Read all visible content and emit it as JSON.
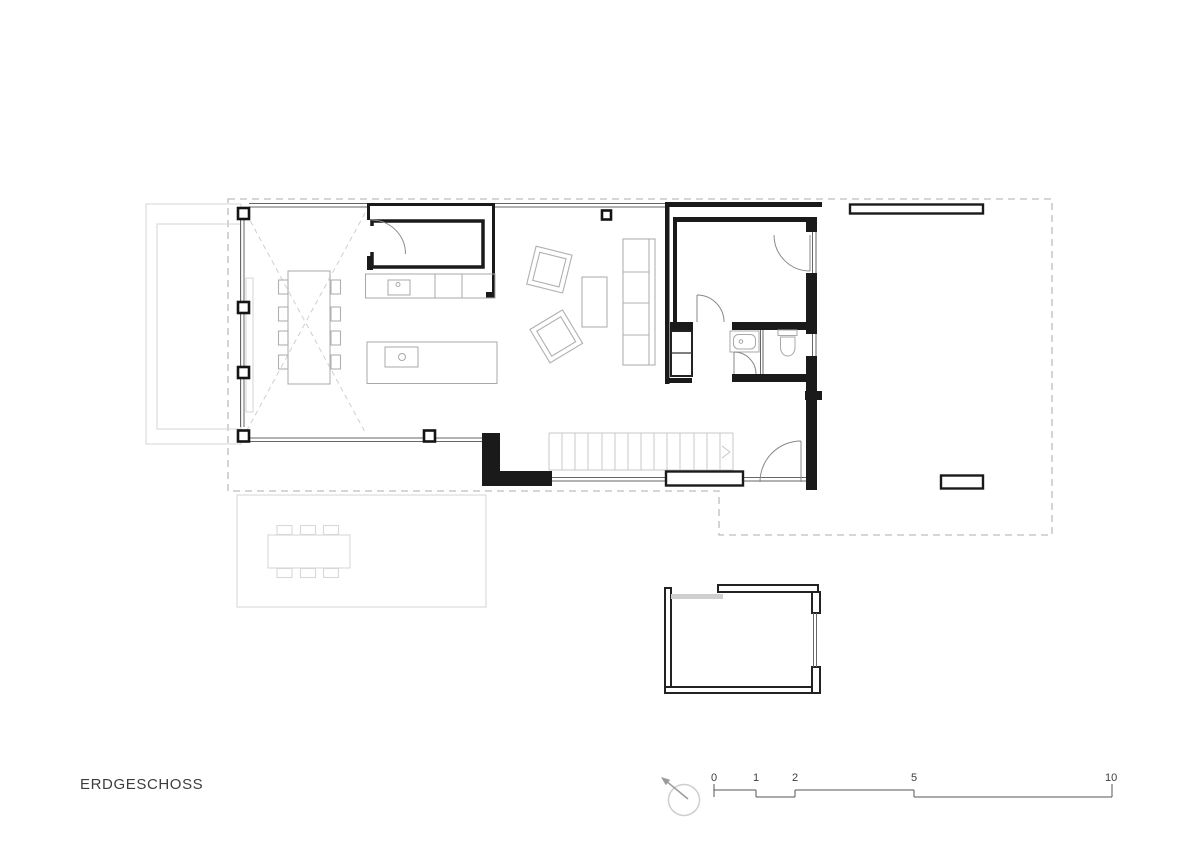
{
  "title": "ERDGESCHOSS",
  "scale_bar": {
    "marks": [
      {
        "label": "0"
      },
      {
        "label": "1"
      },
      {
        "label": "2"
      },
      {
        "label": "5"
      },
      {
        "label": "10"
      }
    ]
  },
  "compass": {
    "icon": "north-arrow"
  },
  "colors": {
    "wall_ink": "#1a1a1a",
    "line": "#666666",
    "furniture": "#b0b0b0",
    "ghost": "#d8d8d8",
    "roof_dash": "#bdbdbd",
    "text": "#3d3d3d",
    "paper": "#ffffff"
  }
}
